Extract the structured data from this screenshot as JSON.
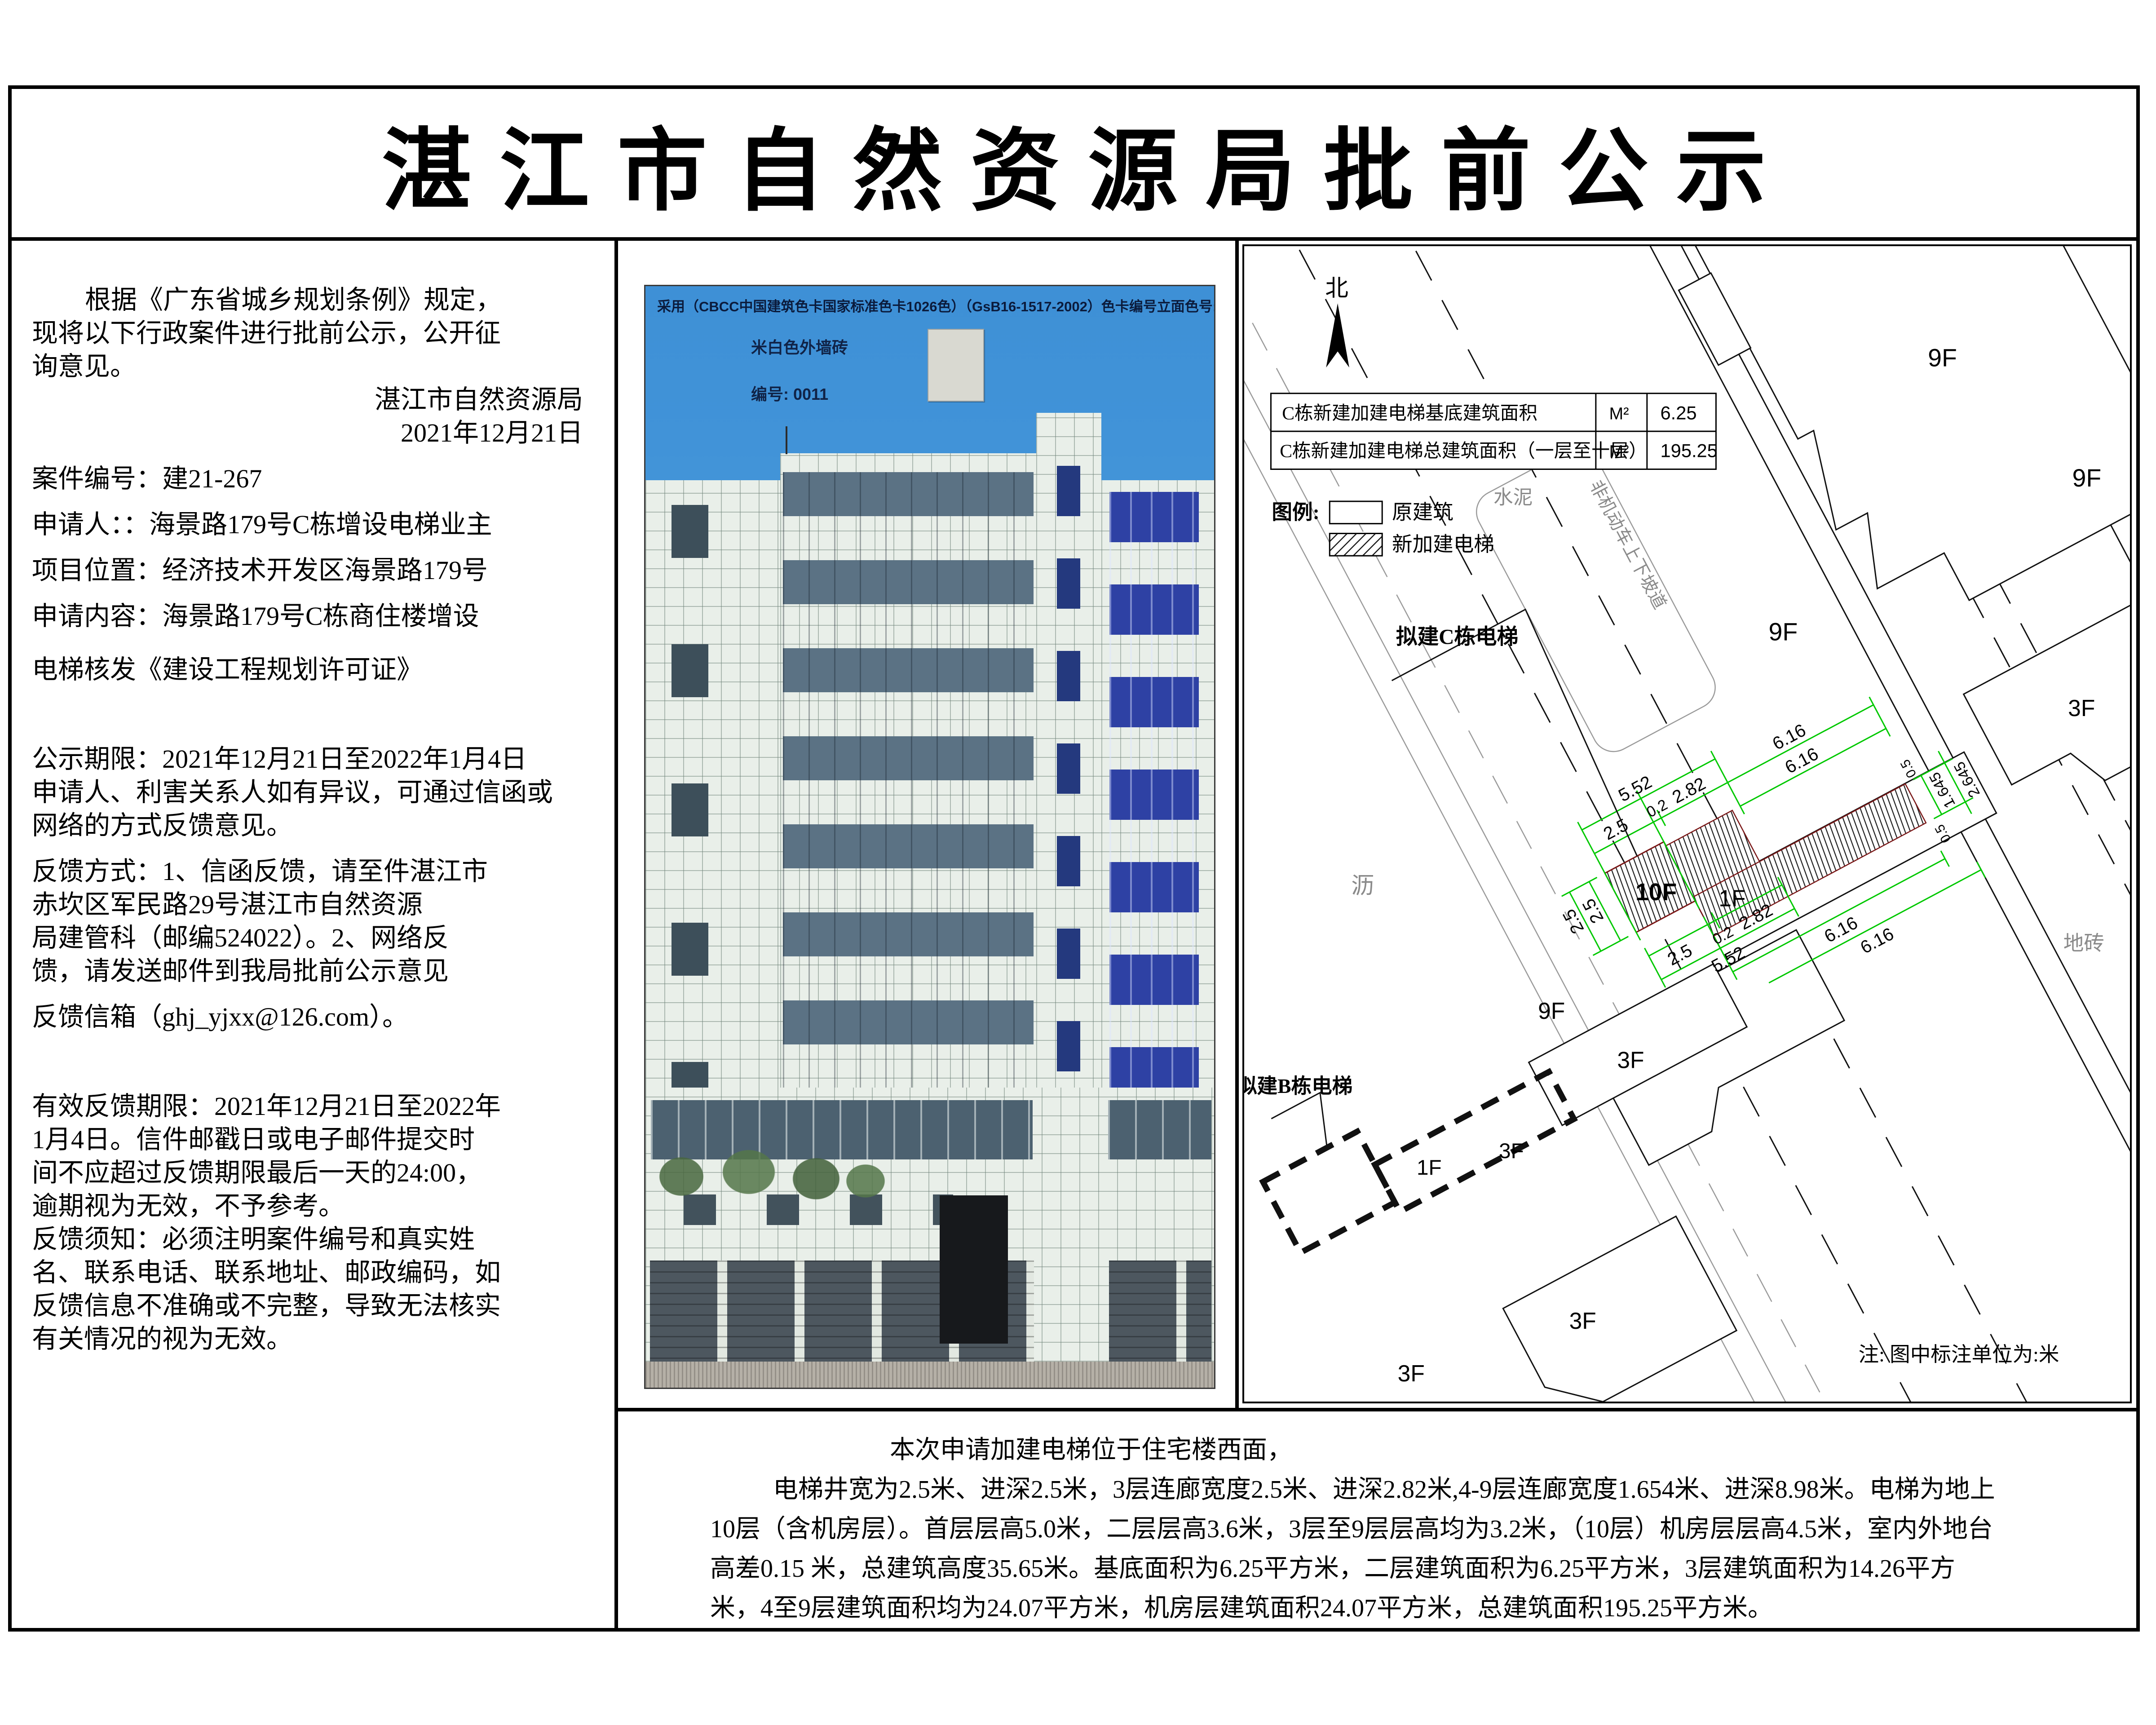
{
  "page": {
    "title": "湛江市自然资源局批前公示"
  },
  "left": {
    "lines": [
      "根据《广东省城乡规划条例》规定，",
      "现将以下行政案件进行批前公示，公开征",
      "询意见。",
      "湛江市自然资源局",
      "2021年12月21日",
      "案件编号：建21-267",
      "申请人：：海景路179号C栋增设电梯业主",
      "项目位置：经济技术开发区海景路179号",
      "申请内容：海景路179号C栋商住楼增设",
      "电梯核发《建设工程规划许可证》",
      "公示期限：2021年12月21日至2022年1月4日",
      "申请人、利害关系人如有异议，可通过信函或",
      "网络的方式反馈意见。",
      "反馈方式：1、信函反馈，请至件湛江市",
      "赤坎区军民路29号湛江市自然资源",
      "局建管科（邮编524022）。2、网络反",
      "馈，请发送邮件到我局批前公示意见",
      "反馈信箱（ghj_yjxx@126.com）。",
      "有效反馈期限：2021年12月21日至2022年",
      "1月4日。信件邮戳日或电子邮件提交时",
      "间不应超过反馈期限最后一天的24:00，",
      "逾期视为无效，不予参考。",
      "反馈须知：必须注明案件编号和真实姓",
      "名、联系电话、联系地址、邮政编码，如",
      "反馈信息不准确或不完整，导致无法核实",
      "有关情况的视为无效。"
    ]
  },
  "photo": {
    "header": "采用（CBCC中国建筑色卡国家标准色卡1026色）（GsB16-1517-2002）色卡编号立面色号:",
    "swatch_name": "米白色外墙砖",
    "swatch_code": "编号: 0011",
    "swatch_color": "#d9d9d1",
    "sky_color": "#4a9cdd"
  },
  "plan": {
    "north": "北",
    "table": {
      "rows": [
        {
          "label": "C栋新建加建电梯基底建筑面积",
          "unit": "M²",
          "value": "6.25"
        },
        {
          "label": "C栋新建加建电梯总建筑面积（一层至十层）",
          "unit": "M²",
          "value": "195.25"
        }
      ]
    },
    "legend": {
      "title": "图例:",
      "original": "原建筑",
      "new": "新加建电梯"
    },
    "labels": {
      "c_elevator": "拟建C栋电梯",
      "b_elevator": "拟建B栋电梯",
      "cement": "水泥",
      "ramp": "非机动车上下坡道",
      "asphalt": "沥",
      "tile": "地砖",
      "note": "注: 图中标注单位为:米"
    },
    "floors": [
      "10F",
      "1F",
      "9F",
      "9F",
      "9F",
      "3F",
      "3F",
      "3F",
      "9F",
      "1F",
      "3F",
      "3F"
    ],
    "dims": [
      "2.5",
      "0.2",
      "2.82",
      "5.52",
      "6.16",
      "6.16",
      "2.5",
      "2.5",
      "2.5",
      "0.2",
      "2.82",
      "5.52",
      "6.16",
      "6.16",
      "1.645",
      "2.645",
      "0.5",
      "0.5"
    ],
    "dim_color": "#00c800"
  },
  "bottom": {
    "lines": [
      "本次申请加建电梯位于住宅楼西面，",
      "电梯井宽为2.5米、进深2.5米，3层连廊宽度2.5米、进深2.82米,4-9层连廊宽度1.654米、进深8.98米。电梯为地上",
      "10层（含机房层）。首层层高5.0米，二层层高3.6米，3层至9层层高均为3.2米，（10层）机房层层高4.5米，室内外地台",
      "高差0.15 米，总建筑高度35.65米。基底面积为6.25平方米，二层建筑面积为6.25平方米，3层建筑面积为14.26平方",
      "米，4至9层建筑面积均为24.07平方米，机房层建筑面积24.07平方米，总建筑面积195.25平方米。"
    ]
  }
}
